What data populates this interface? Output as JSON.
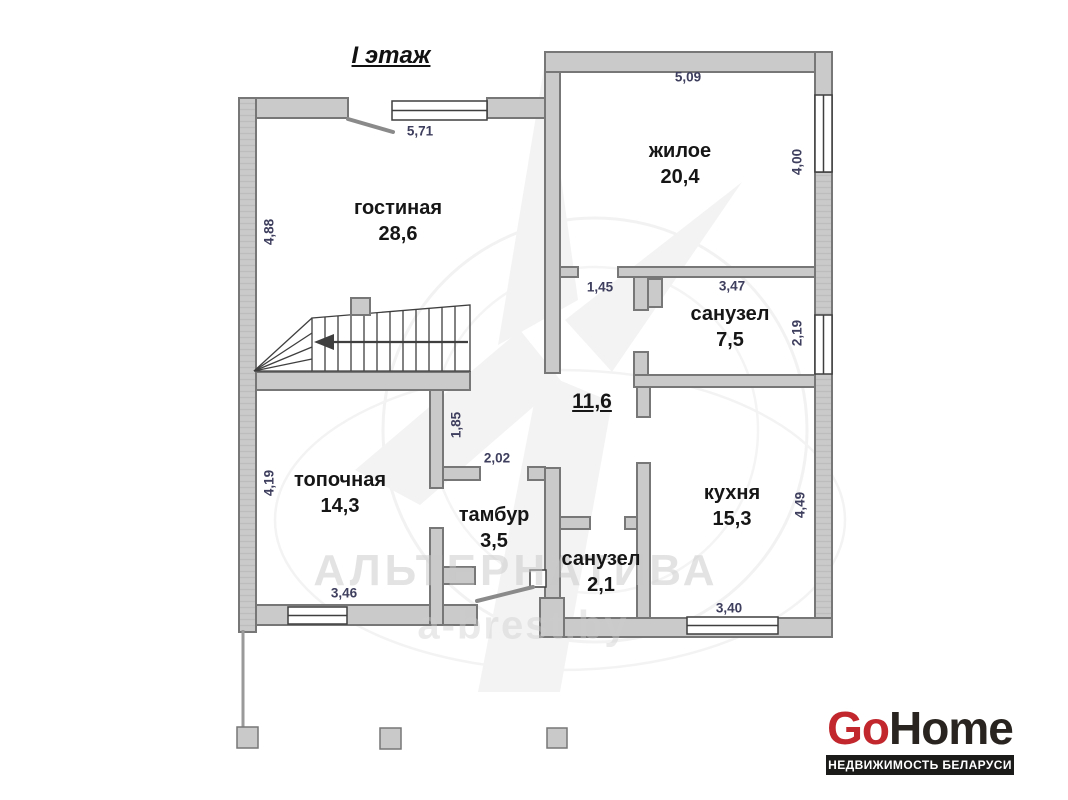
{
  "title": "I этаж",
  "plan": {
    "rooms": [
      {
        "name": "гостиная",
        "area": "28,6"
      },
      {
        "name": "жилое",
        "area": "20,4"
      },
      {
        "name": "санузел",
        "area": "7,5"
      },
      {
        "name": "кухня",
        "area": "15,3"
      },
      {
        "name": "топочная",
        "area": "14,3"
      },
      {
        "name": "тамбур",
        "area": "3,5"
      },
      {
        "name": "санузел",
        "area": "2,1"
      }
    ],
    "hall_area": "11,6",
    "dims": {
      "d571": "5,71",
      "d509": "5,09",
      "d400": "4,00",
      "d488": "4,88",
      "d145": "1,45",
      "d347": "3,47",
      "d219": "2,19",
      "d185": "1,85",
      "d202": "2,02",
      "d419": "4,19",
      "d449": "4,49",
      "d346": "3,46",
      "d340": "3,40"
    }
  },
  "watermark": {
    "name": "АЛЬТЕРНАТИВА",
    "site": "a-brest.by"
  },
  "logo": {
    "part1": "Go",
    "part2": "Home",
    "tagline": "НЕДВИЖИМОСТЬ БЕЛАРУСИ"
  },
  "colors": {
    "wall_fill": "#cacaca",
    "wall_stroke": "#777777",
    "dimension_text": "#3e3e5e",
    "room_text": "#161616",
    "logo_red": "#c1272d",
    "logo_dark": "#29241f",
    "logo_bar": "#1b1b19"
  }
}
